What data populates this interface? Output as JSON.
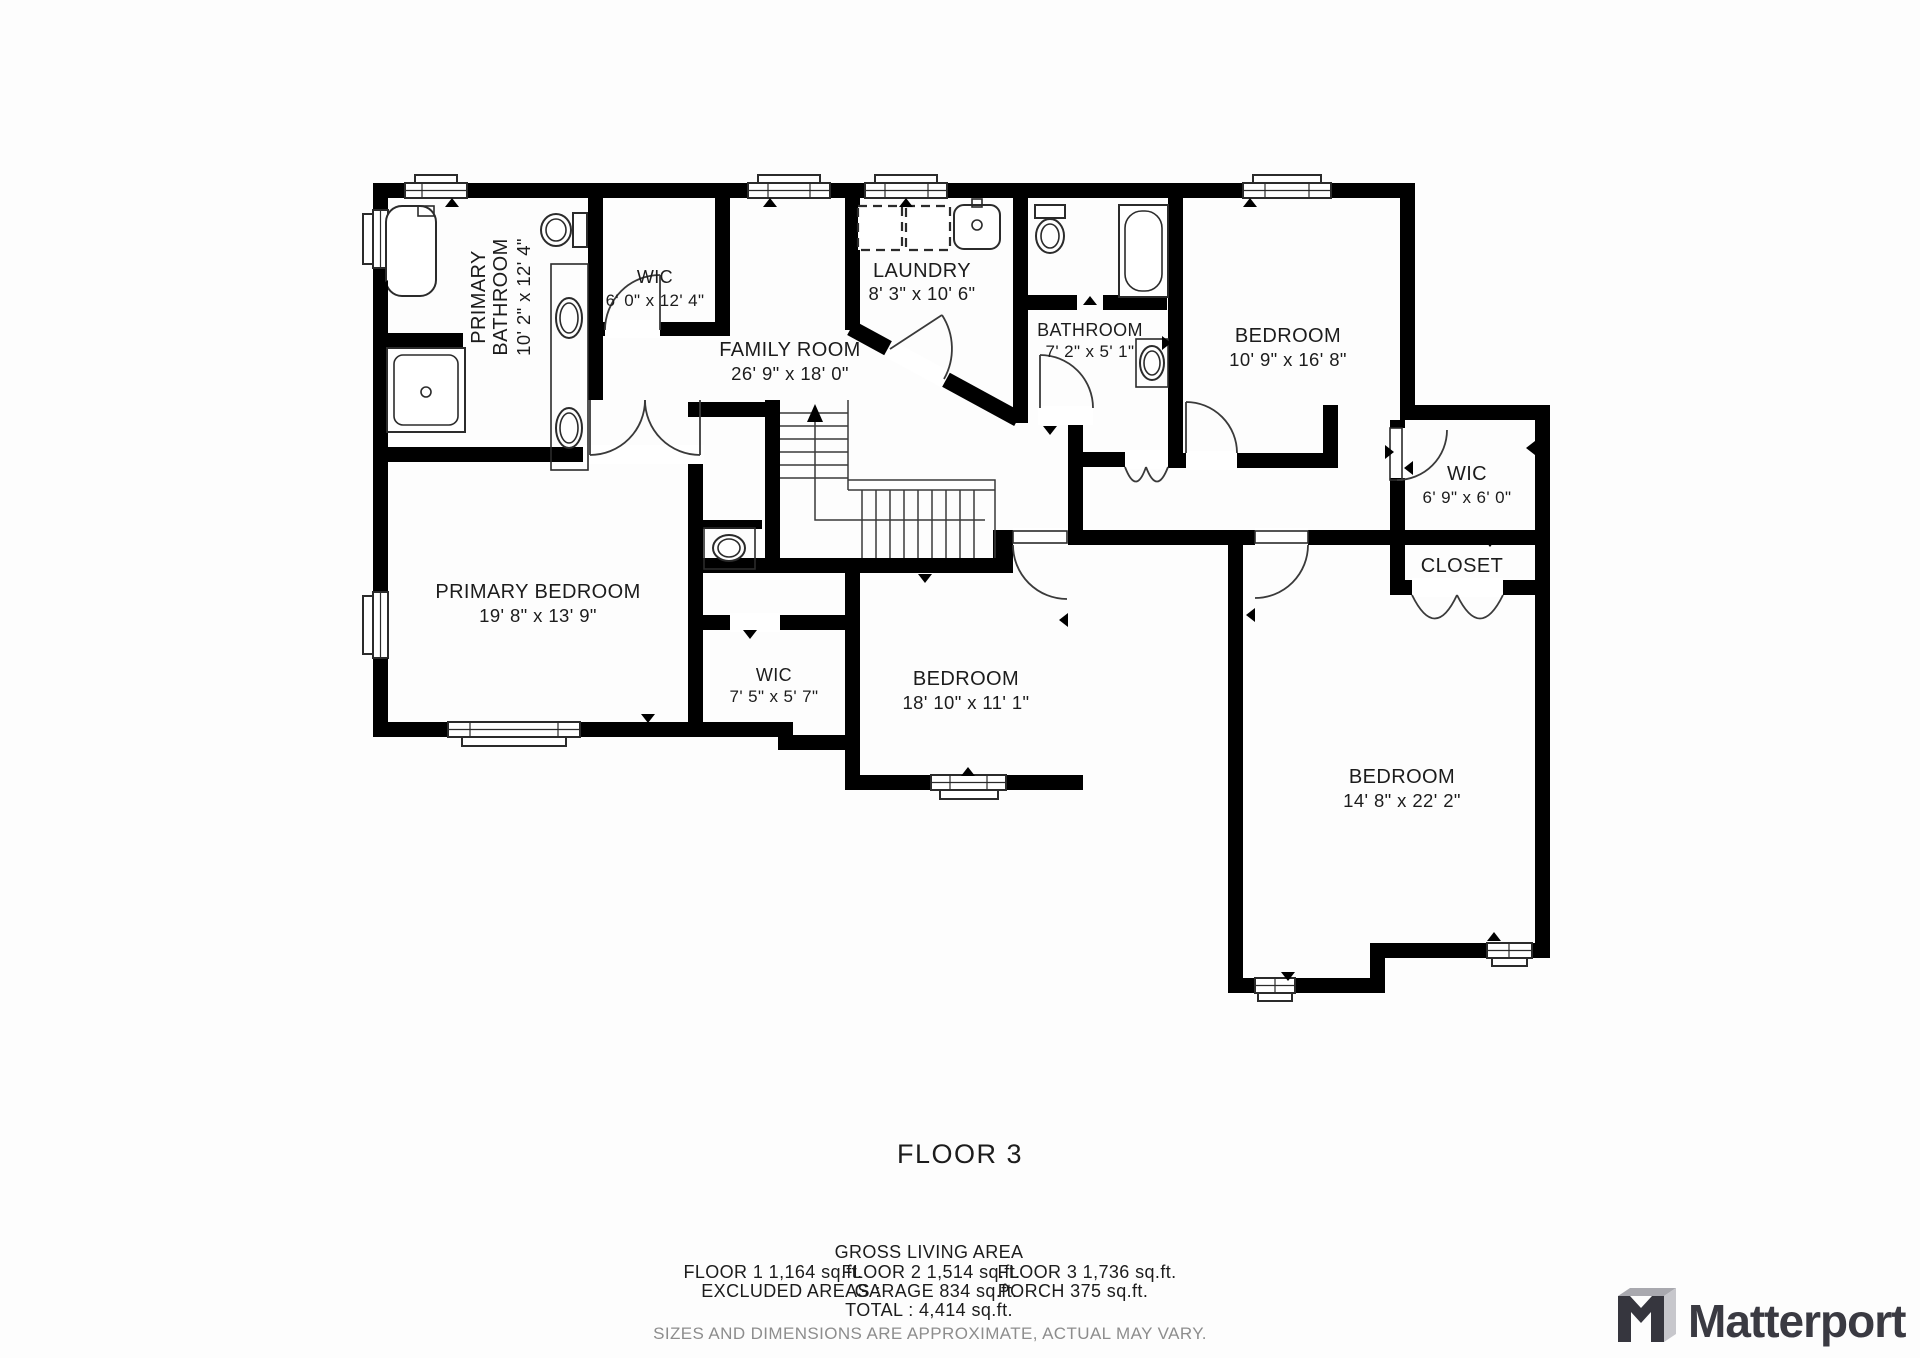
{
  "floor_title": "FLOOR 3",
  "rooms": {
    "primary_bathroom": {
      "name_lines": [
        "PRIMARY",
        "BATHROOM"
      ],
      "dims": "10' 2\" x 12' 4\""
    },
    "wic_primary": {
      "name": "WIC",
      "dims": "6' 0\" x 12' 4\""
    },
    "laundry": {
      "name": "LAUNDRY",
      "dims": "8' 3\" x 10' 6\""
    },
    "family_room": {
      "name": "FAMILY ROOM",
      "dims": "26' 9\" x 18' 0\""
    },
    "bathroom": {
      "name": "BATHROOM",
      "dims": "7' 2\" x 5' 1\""
    },
    "bedroom_top": {
      "name": "BEDROOM",
      "dims": "10' 9\" x 16' 8\""
    },
    "wic_right": {
      "name": "WIC",
      "dims": "6' 9\" x 6' 0\""
    },
    "closet": {
      "name": "CLOSET"
    },
    "primary_bedroom": {
      "name": "PRIMARY BEDROOM",
      "dims": "19' 8\" x 13' 9\""
    },
    "wic_small": {
      "name": "WIC",
      "dims": "7' 5\" x 5' 7\""
    },
    "bedroom_middle": {
      "name": "BEDROOM",
      "dims": "18' 10\" x 11' 1\""
    },
    "bedroom_large": {
      "name": "BEDROOM",
      "dims": "14' 8\" x 22' 2\""
    }
  },
  "summary": {
    "gross_title": "GROSS LIVING AREA",
    "floor1": "FLOOR 1 1,164 sq.ft.",
    "floor2": "FLOOR 2 1,514 sq.ft.",
    "floor3": "FLOOR 3 1,736 sq.ft.",
    "excluded_label": "EXCLUDED AREAS :",
    "garage": "GARAGE 834 sq.ft.",
    "porch": "PORCH 375 sq.ft.",
    "total": "TOTAL :  4,414 sq.ft.",
    "disclaimer": "SIZES AND DIMENSIONS ARE APPROXIMATE, ACTUAL MAY VARY."
  },
  "brand": {
    "name": "Matterport"
  },
  "colors": {
    "wall": "#000000",
    "text": "#1c1c1c",
    "muted": "#8d8d8d",
    "brand": "#3a3a42"
  }
}
